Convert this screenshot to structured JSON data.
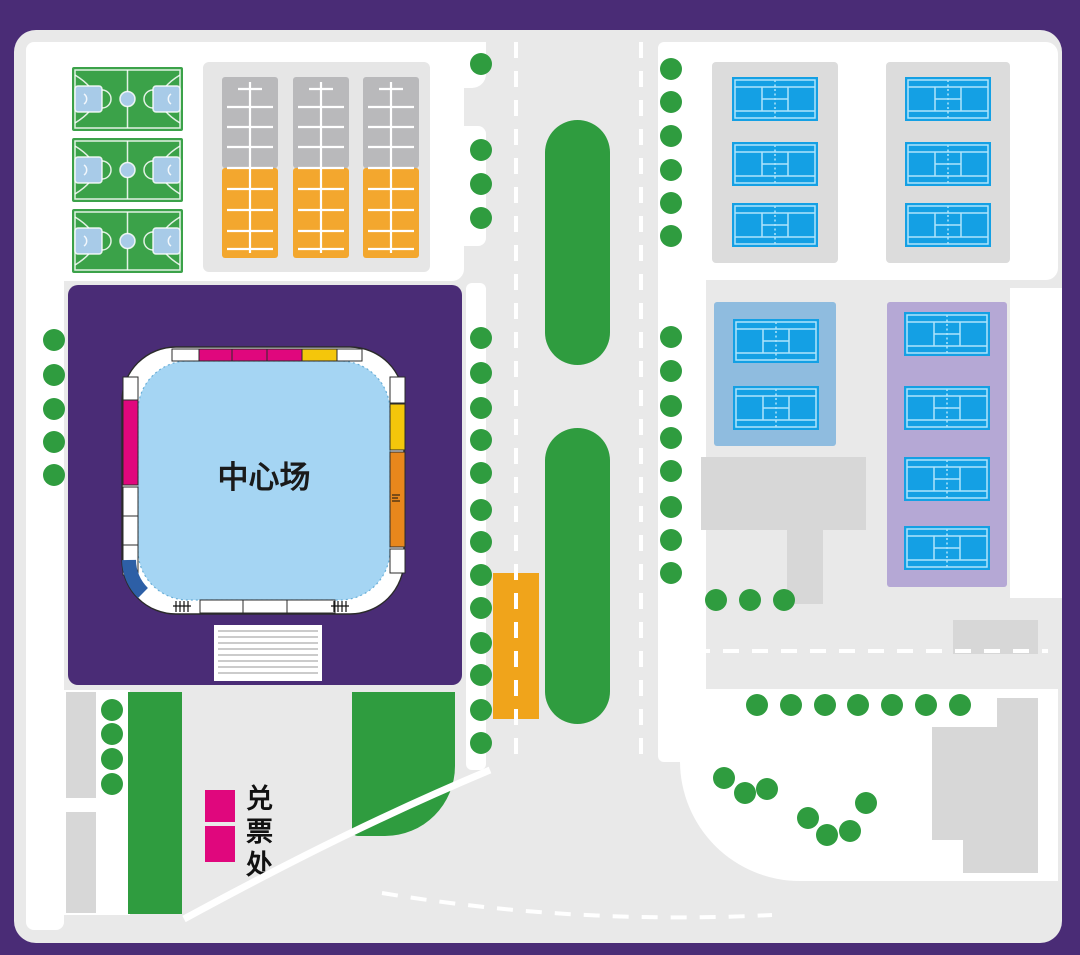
{
  "poster_type": "sports-venue-site-map",
  "stadium": {
    "label": "中心场"
  },
  "ticket_office": {
    "label": "兑票处",
    "booth_count": 2
  },
  "colors": {
    "frame_purple": "#4A2C76",
    "background_gray": "#E9E9E9",
    "green": "#2F9C3F",
    "basketball_green": "#3BA249",
    "tennis_blue": "#14A0E4",
    "tennis_line": "#AEE4FB",
    "stand_gray": "#B9B9BB",
    "stand_orange": "#F3A72E",
    "court_lightblue": "#A5D5F3",
    "magenta": "#E0077D",
    "yellow": "#F4C60B",
    "seat_orange": "#E8871C",
    "seat_blue": "#2D5FA6",
    "blue_panel": "#8FBCDF",
    "lavender_panel": "#B5A8D5",
    "bus_bay_orange": "#F0A41B"
  },
  "facility_counts": {
    "basketball_courts": 3,
    "grandstand_practice_courts": 3,
    "tennis_courts_gray_panels": 6,
    "tennis_courts_blue_panel": 2,
    "tennis_courts_lavender_panel": 4,
    "trees": 57
  },
  "map": {
    "basketball_courts": [
      [
        72,
        67
      ],
      [
        72,
        138
      ],
      [
        72,
        209
      ]
    ],
    "grandstand_courts": [
      [
        222,
        77
      ],
      [
        293,
        77
      ],
      [
        363,
        77
      ]
    ],
    "tennis_courts": [
      [
        732,
        77
      ],
      [
        732,
        142
      ],
      [
        732,
        203
      ],
      [
        905,
        77
      ],
      [
        905,
        142
      ],
      [
        905,
        203
      ],
      [
        733,
        319
      ],
      [
        733,
        386
      ],
      [
        904,
        312
      ],
      [
        904,
        386
      ],
      [
        904,
        457
      ],
      [
        904,
        526
      ]
    ],
    "trees": [
      [
        54,
        340
      ],
      [
        54,
        375
      ],
      [
        54,
        409
      ],
      [
        54,
        442
      ],
      [
        54,
        475
      ],
      [
        481,
        64
      ],
      [
        481,
        150
      ],
      [
        481,
        184
      ],
      [
        481,
        218
      ],
      [
        481,
        338
      ],
      [
        481,
        373
      ],
      [
        481,
        408
      ],
      [
        481,
        440
      ],
      [
        481,
        473
      ],
      [
        481,
        510
      ],
      [
        481,
        542
      ],
      [
        481,
        575
      ],
      [
        481,
        608
      ],
      [
        481,
        643
      ],
      [
        481,
        675
      ],
      [
        481,
        710
      ],
      [
        481,
        743
      ],
      [
        671,
        69
      ],
      [
        671,
        102
      ],
      [
        671,
        136
      ],
      [
        671,
        170
      ],
      [
        671,
        203
      ],
      [
        671,
        236
      ],
      [
        671,
        337
      ],
      [
        671,
        371
      ],
      [
        671,
        406
      ],
      [
        671,
        438
      ],
      [
        671,
        471
      ],
      [
        671,
        507
      ],
      [
        671,
        540
      ],
      [
        671,
        573
      ],
      [
        716,
        600
      ],
      [
        750,
        600
      ],
      [
        784,
        600
      ],
      [
        112,
        710
      ],
      [
        112,
        734
      ],
      [
        112,
        759
      ],
      [
        112,
        784
      ],
      [
        757,
        705
      ],
      [
        791,
        705
      ],
      [
        825,
        705
      ],
      [
        858,
        705
      ],
      [
        892,
        705
      ],
      [
        926,
        705
      ],
      [
        960,
        705
      ],
      [
        724,
        778
      ],
      [
        745,
        793
      ],
      [
        767,
        789
      ],
      [
        808,
        818
      ],
      [
        827,
        835
      ],
      [
        850,
        831
      ],
      [
        866,
        803
      ]
    ]
  }
}
